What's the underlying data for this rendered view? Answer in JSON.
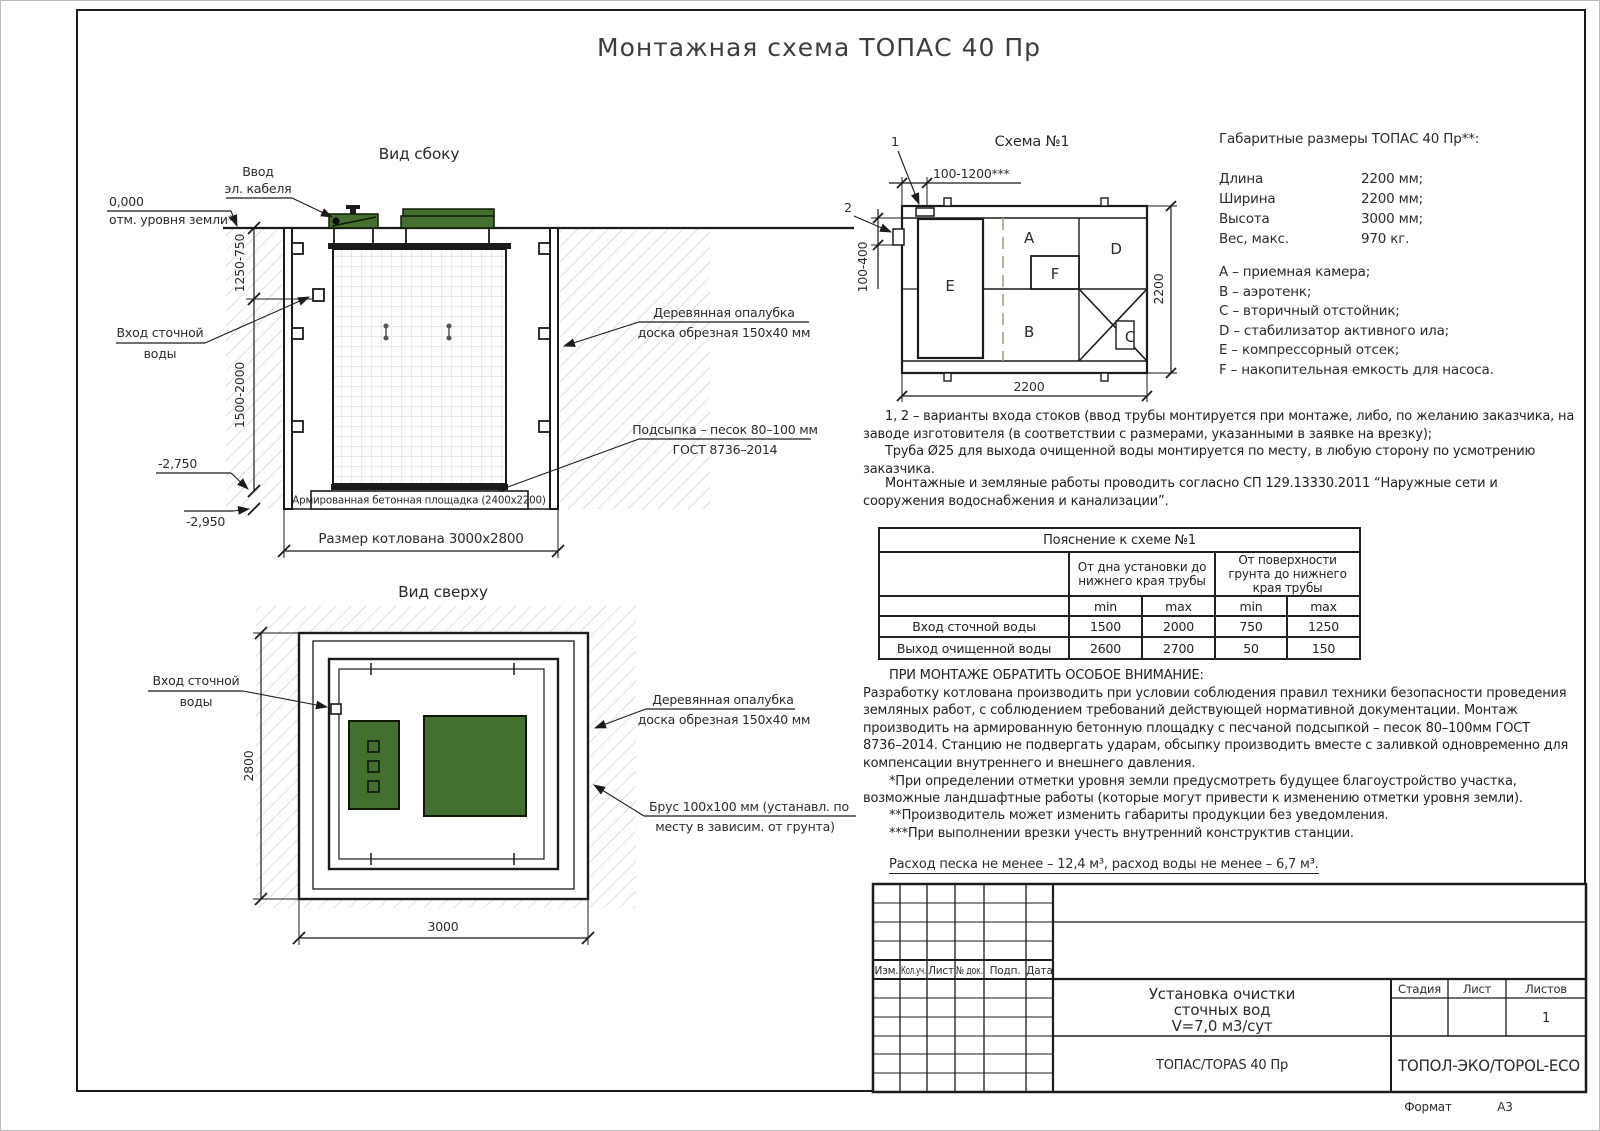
{
  "page": {
    "title": "Монтажная схема ТОПАС 40 Пр",
    "format_label": "Формат",
    "format_value": "А3"
  },
  "side_view": {
    "title": "Вид сбоку",
    "cable_entry_line1": "Ввод",
    "cable_entry_line2": "эл. кабеля",
    "ground_mark": "0,000",
    "ground_label": "отм. уровня земли*",
    "inlet_line1": "Вход сточной",
    "inlet_line2": "воды",
    "dim_upper": "1250-750",
    "dim_lower": "1500-2000",
    "elev_pad": "-2,750",
    "elev_bottom": "-2,950",
    "formwork_line1": "Деревянная опалубка",
    "formwork_line2": "доска обрезная 150х40 мм",
    "bedding_line1": "Подсыпка – песок 80–100 мм",
    "bedding_line2": "ГОСТ 8736–2014",
    "pad_label": "Армированная бетонная площадка (2400х2200)",
    "pit_dim": "Размер котлована 3000х2800"
  },
  "top_view": {
    "title": "Вид сверху",
    "inlet_line1": "Вход сточной",
    "inlet_line2": "воды",
    "formwork_line1": "Деревянная опалубка",
    "formwork_line2": "доска обрезная 150х40 мм",
    "beam_line1": "Брус 100х100 мм (устанавл. по",
    "beam_line2": "месту в зависим. от грунта)",
    "dim_height": "2800",
    "dim_width": "3000"
  },
  "schema": {
    "title": "Схема №1",
    "marker1": "1",
    "marker2": "2",
    "dim_top": "100-1200***",
    "dim_left": "100-400",
    "dim_right": "2200",
    "dim_bottom": "2200",
    "room_a": "A",
    "room_b": "B",
    "room_c": "C",
    "room_d": "D",
    "room_e": "E",
    "room_f": "F"
  },
  "specs": {
    "title": "Габаритные размеры ТОПАС 40 Пр**:",
    "rows": [
      {
        "label": "Длина",
        "value": "2200 мм;"
      },
      {
        "label": "Ширина",
        "value": "2200 мм;"
      },
      {
        "label": "Высота",
        "value": "3000 мм;"
      },
      {
        "label": "Вес, макс.",
        "value": "970 кг."
      }
    ],
    "legend": [
      "A – приемная камера;",
      "B – аэротенк;",
      "C – вторичный отстойник;",
      "D – стабилизатор активного ила;",
      "E – компрессорный отсек;",
      "F – накопительная емкость для насоса."
    ]
  },
  "notes": {
    "variants_p1": "1, 2 – варианты входа  стоков (ввод трубы монтируется при монтаже, либо, по желанию заказчика, на заводе изготовителя (в соответствии с размерами, указанными в заявке на врезку);",
    "variants_p2": "Труба Ø25 для выхода очищенной воды монтируется по месту, в любую сторону по усмотрению заказчика.",
    "sp_note": "Монтажные и земляные работы проводить согласно СП 129.13330.2011 “Наружные сети и сооружения водоснабжения и канализации”.",
    "attention_title": "ПРИ МОНТАЖЕ ОБРАТИТЬ ОСОБОЕ ВНИМАНИЕ:",
    "attention_body": "Разработку котлована производить при условии соблюдения правил техники безопасности проведения земляных работ, с соблюдением требований действующей нормативной документации.  Монтаж производить на армированную бетонную площадку с песчаной подсыпкой – песок 80–100мм ГОСТ 8736–2014. Станцию не подвергать ударам, обсыпку производить вместе с заливкой одновременно для компенсации внутреннего и внешнего давления.",
    "footnote1": "*При определении отметки уровня земли предусмотреть будущее благоустройство участка, возможные ландшафтные работы (которые могут привести к изменению отметки уровня земли).",
    "footnote2": "**Производитель может изменить габариты продукции без уведомления.",
    "footnote3": "***При выполнении врезки учесть внутренний конструктив станции.",
    "consumption": "Расход песка не менее – 12,4 м³, расход воды не менее – 6,7 м³."
  },
  "explanation_table": {
    "title": "Пояснение к схеме №1",
    "group1": "От дна установки до нижнего края трубы",
    "group2": "От поверхности грунта до нижнего края трубы",
    "min_label": "min",
    "max_label": "max",
    "rows": [
      {
        "label": "Вход сточной воды",
        "v1": "1500",
        "v2": "2000",
        "v3": "750",
        "v4": "1250"
      },
      {
        "label": "Выход очищенной воды",
        "v1": "2600",
        "v2": "2700",
        "v3": "50",
        "v4": "150"
      }
    ]
  },
  "stamp": {
    "cols": [
      "Изм.",
      "Кол.уч.",
      "Лист",
      "№ док.",
      "Подп.",
      "Дата"
    ],
    "title_line1": "Установка очистки",
    "title_line2": "сточных вод",
    "title_line3": "V=7,0 м3/сут",
    "stage": "Стадия",
    "sheet": "Лист",
    "sheets": "Листов",
    "sheets_value": "1",
    "product": "ТОПАС/TOPAS 40 Пр",
    "company": "ТОПОЛ-ЭКО/TOPOL-ECO"
  }
}
